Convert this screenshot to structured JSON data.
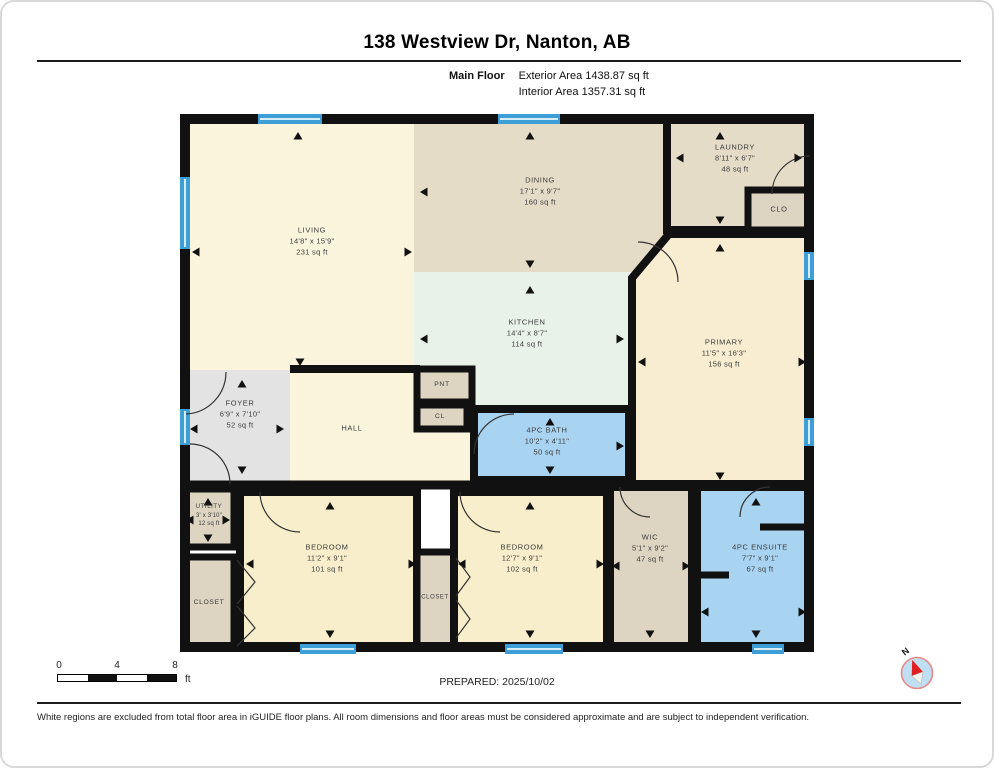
{
  "header": {
    "title": "138 Westview Dr, Nanton, AB",
    "floor_label": "Main Floor",
    "exterior_area": "Exterior Area 1438.87 sq ft",
    "interior_area": "Interior Area 1357.31 sq ft"
  },
  "rooms": {
    "living": {
      "name": "LIVING",
      "dims": "14'8\" x 15'9\"",
      "area": "231 sq ft"
    },
    "dining": {
      "name": "DINING",
      "dims": "17'1\" x 9'7\"",
      "area": "160 sq ft"
    },
    "laundry": {
      "name": "LAUNDRY",
      "dims": "8'11\" x 6'7\"",
      "area": "48 sq ft"
    },
    "clo": {
      "name": "CLO"
    },
    "kitchen": {
      "name": "KITCHEN",
      "dims": "14'4\" x 8'7\"",
      "area": "114 sq ft"
    },
    "primary": {
      "name": "PRIMARY",
      "dims": "11'5\" x 16'3\"",
      "area": "156 sq ft"
    },
    "foyer": {
      "name": "FOYER",
      "dims": "6'9\" x 7'10\"",
      "area": "52 sq ft"
    },
    "hall": {
      "name": "HALL"
    },
    "pnt": {
      "name": "PNT"
    },
    "cl": {
      "name": "CL"
    },
    "bath": {
      "name": "4PC BATH",
      "dims": "10'2\" x 4'11\"",
      "area": "50 sq ft"
    },
    "utility": {
      "name": "UTILITY",
      "dims": "3' x 3'10\"",
      "area": "12 sq ft"
    },
    "closet_left": {
      "name": "CLOSET"
    },
    "bedroom1": {
      "name": "BEDROOM",
      "dims": "11'2\" x 9'1\"",
      "area": "101 sq ft"
    },
    "closet_mid": {
      "name": "CLOSET"
    },
    "bedroom2": {
      "name": "BEDROOM",
      "dims": "12'7\" x 9'1\"",
      "area": "102 sq ft"
    },
    "wic": {
      "name": "WIC",
      "dims": "5'1\" x 9'2\"",
      "area": "47 sq ft"
    },
    "ensuite": {
      "name": "4PC ENSUITE",
      "dims": "7'7\" x 9'1\"",
      "area": "67 sq ft"
    }
  },
  "scale_bar": {
    "labels": [
      "0",
      "4",
      "8"
    ],
    "unit": "ft"
  },
  "compass": {
    "n_label": "N"
  },
  "footer": {
    "prepared": "PREPARED: 2025/10/02",
    "disclaimer": "White regions are excluded from total floor area in iGUIDE floor plans. All room dimensions and floor areas must be considered approximate and are subject to independent verification."
  },
  "colors": {
    "wall": "#111111",
    "window_blue": "#3d9fd6",
    "cream": "#fbf4dd",
    "tan": "#e5dcc7",
    "beige": "#ddd4c2",
    "mint": "#e9f2e9",
    "blue": "#a9d4f1",
    "grey": "#e3e3e3",
    "yellow": "#f9eecb",
    "primary_yellow": "#f8edd0",
    "compass_fill": "#bfe0f3",
    "compass_ring": "#e98a8a",
    "needle_red": "#e02020"
  }
}
